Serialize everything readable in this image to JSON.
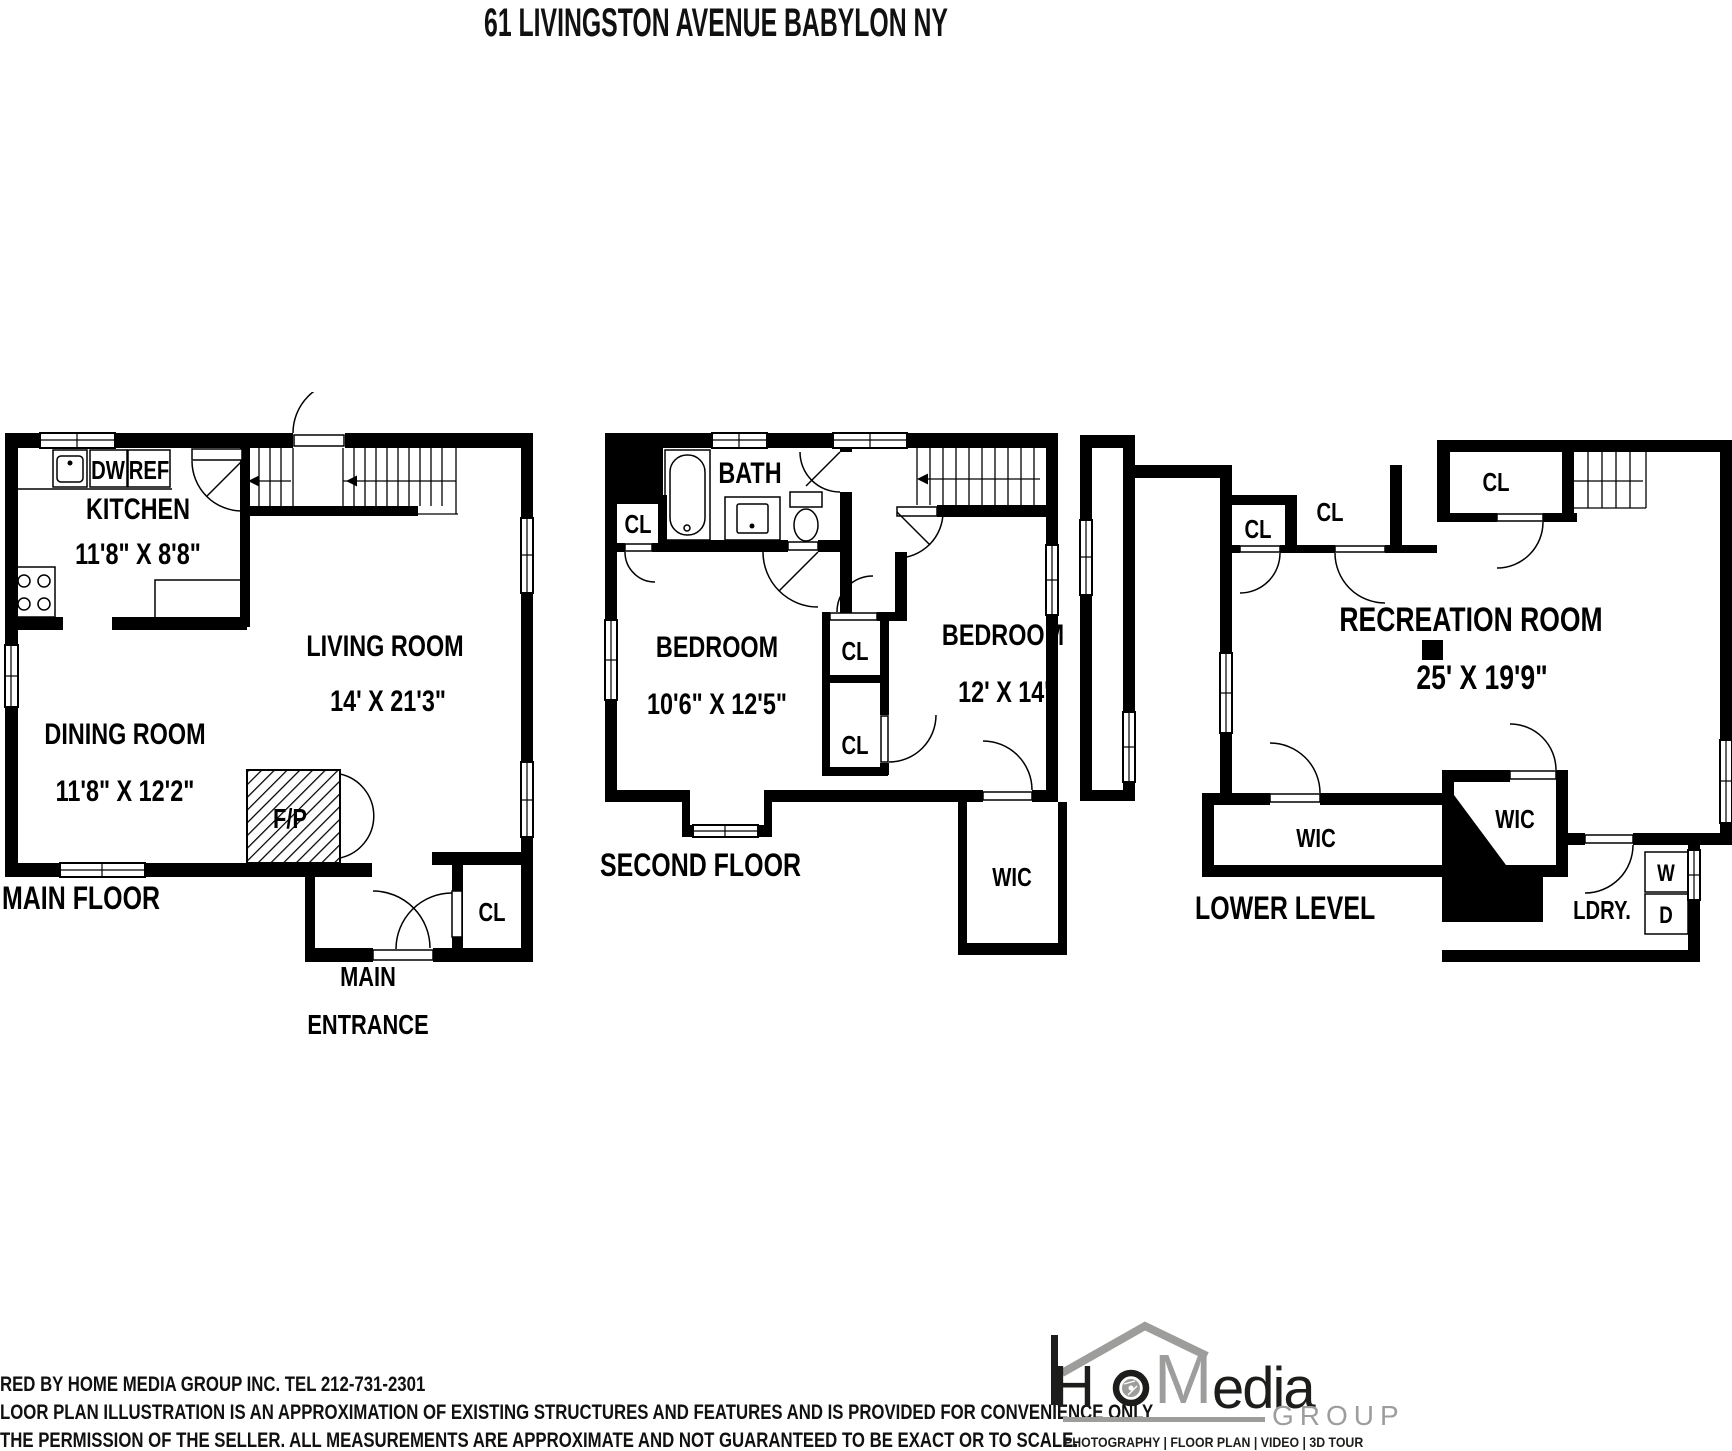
{
  "title": "61 LIVINGSTON AVENUE BABYLON NY",
  "floors": {
    "main": {
      "name": "MAIN FLOOR",
      "kitchen_label": "KITCHEN",
      "kitchen_dims": "11'8\" X 8'8\"",
      "dw": "DW",
      "ref": "REF",
      "living_label": "LIVING ROOM",
      "living_dims": "14' X 21'3\"",
      "dining_label": "DINING ROOM",
      "dining_dims": "11'8\" X 12'2\"",
      "fireplace": "F/P",
      "closet": "CL",
      "entrance_line1": "MAIN",
      "entrance_line2": "ENTRANCE"
    },
    "second": {
      "name": "SECOND FLOOR",
      "bath": "BATH",
      "closet_left": "CL",
      "closet_upper": "CL",
      "closet_lower": "CL",
      "bedroom1_label": "BEDROOM",
      "bedroom1_dims": "10'6\" X 12'5\"",
      "bedroom2_label": "BEDROOM",
      "bedroom2_dims": "12' X 14'",
      "wic": "WIC"
    },
    "lower": {
      "name": "LOWER LEVEL",
      "closet_small": "CL",
      "closet_big": "CL",
      "closet_top": "CL",
      "rec_label": "RECREATION ROOM",
      "rec_dims": "25' X 19'9\"",
      "wic_long": "WIC",
      "wic_diag": "WIC",
      "laundry": "LDRY.",
      "washer": "W",
      "dryer": "D"
    }
  },
  "footer": {
    "line1": "RED BY  HOME MEDIA GROUP INC.  TEL 212-731-2301",
    "line2": "LOOR PLAN ILLUSTRATION IS AN APPROXIMATION OF EXISTING STRUCTURES AND FEATURES AND IS PROVIDED FOR CONVENIENCE ONLY",
    "line3": "THE PERMISSION OF THE SELLER. ALL MEASUREMENTS ARE APPROXIMATE AND NOT GUARANTEED TO BE EXACT OR TO SCALE."
  },
  "logo": {
    "h": "H",
    "m": "M",
    "edia": "edia",
    "group": "GROUP",
    "tagline": "PHOTOGRAPHY | FLOOR PLAN | VIDEO | 3D TOUR"
  },
  "colors": {
    "wall": "#000000",
    "background": "#ffffff",
    "logo_gray": "#9d9d9c",
    "logo_black": "#1d1d1b"
  }
}
